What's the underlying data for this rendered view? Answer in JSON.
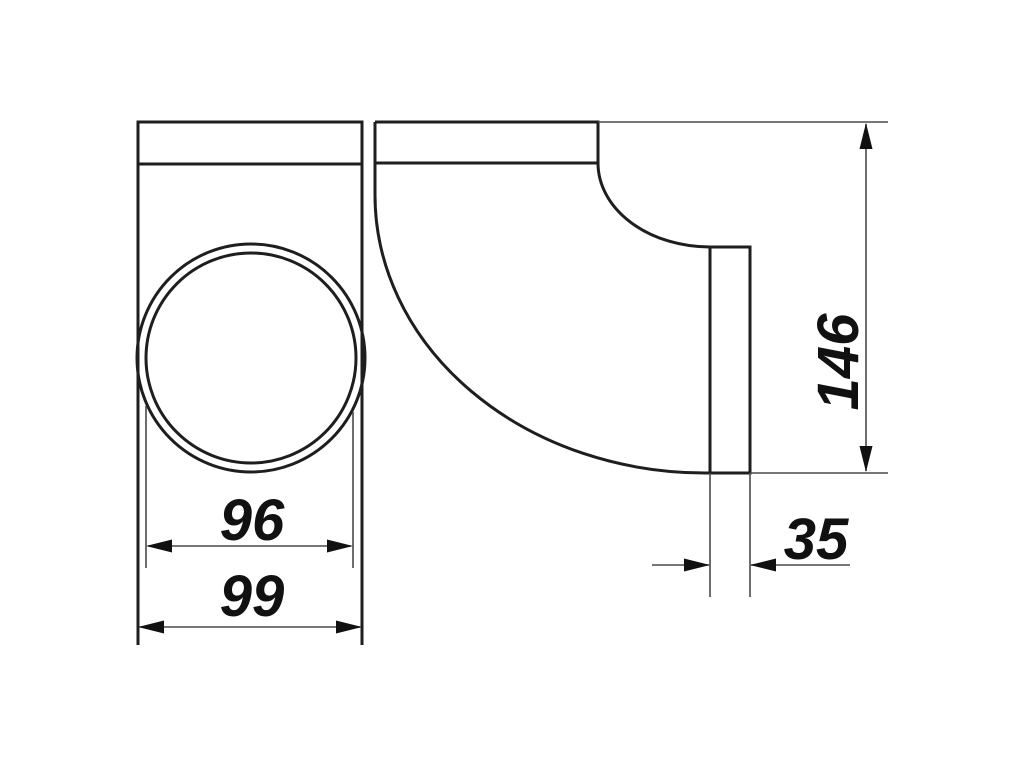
{
  "drawing": {
    "dimensions": {
      "circle_inner_diameter": "96",
      "body_outer_width": "99",
      "total_height": "146",
      "spigot_width": "35"
    },
    "colors": {
      "outline": "#1e1e1e",
      "dim": "#4a4a4a",
      "label": "#111111",
      "background": "#ffffff"
    }
  }
}
